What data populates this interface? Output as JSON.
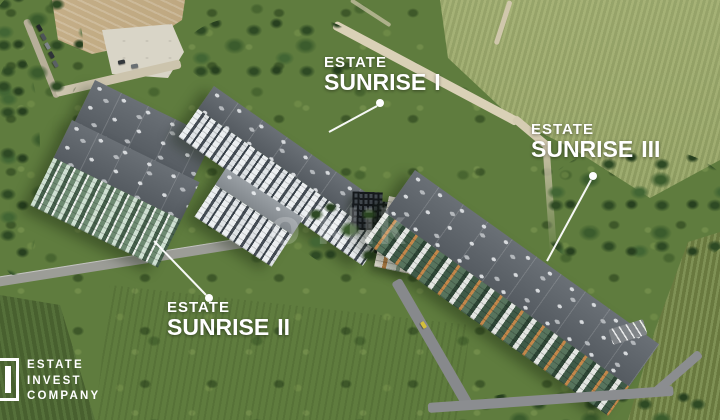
{
  "watermark": {
    "text": "o'klik"
  },
  "overlay": {
    "label_color": "#ffffff",
    "projects": [
      {
        "id": "sunrise-1",
        "brand": "ESTATE",
        "name": "SUNRISE",
        "numeral": "I"
      },
      {
        "id": "sunrise-2",
        "brand": "ESTATE",
        "name": "SUNRISE",
        "numeral": "II"
      },
      {
        "id": "sunrise-3",
        "brand": "ESTATE",
        "name": "SUNRISE",
        "numeral": "III"
      }
    ]
  },
  "logo": {
    "line1": "ESTATE",
    "line2": "INVEST",
    "line3": "COMPANY"
  },
  "scene": {
    "colors": {
      "field_green": "#5f7c3e",
      "dirt_road": "#d9d0b6",
      "asphalt": "#8a8c8e",
      "roof_gray": "#5a6066",
      "facade_accent_orange": "#c3874a",
      "label_text": "#ffffff"
    }
  }
}
